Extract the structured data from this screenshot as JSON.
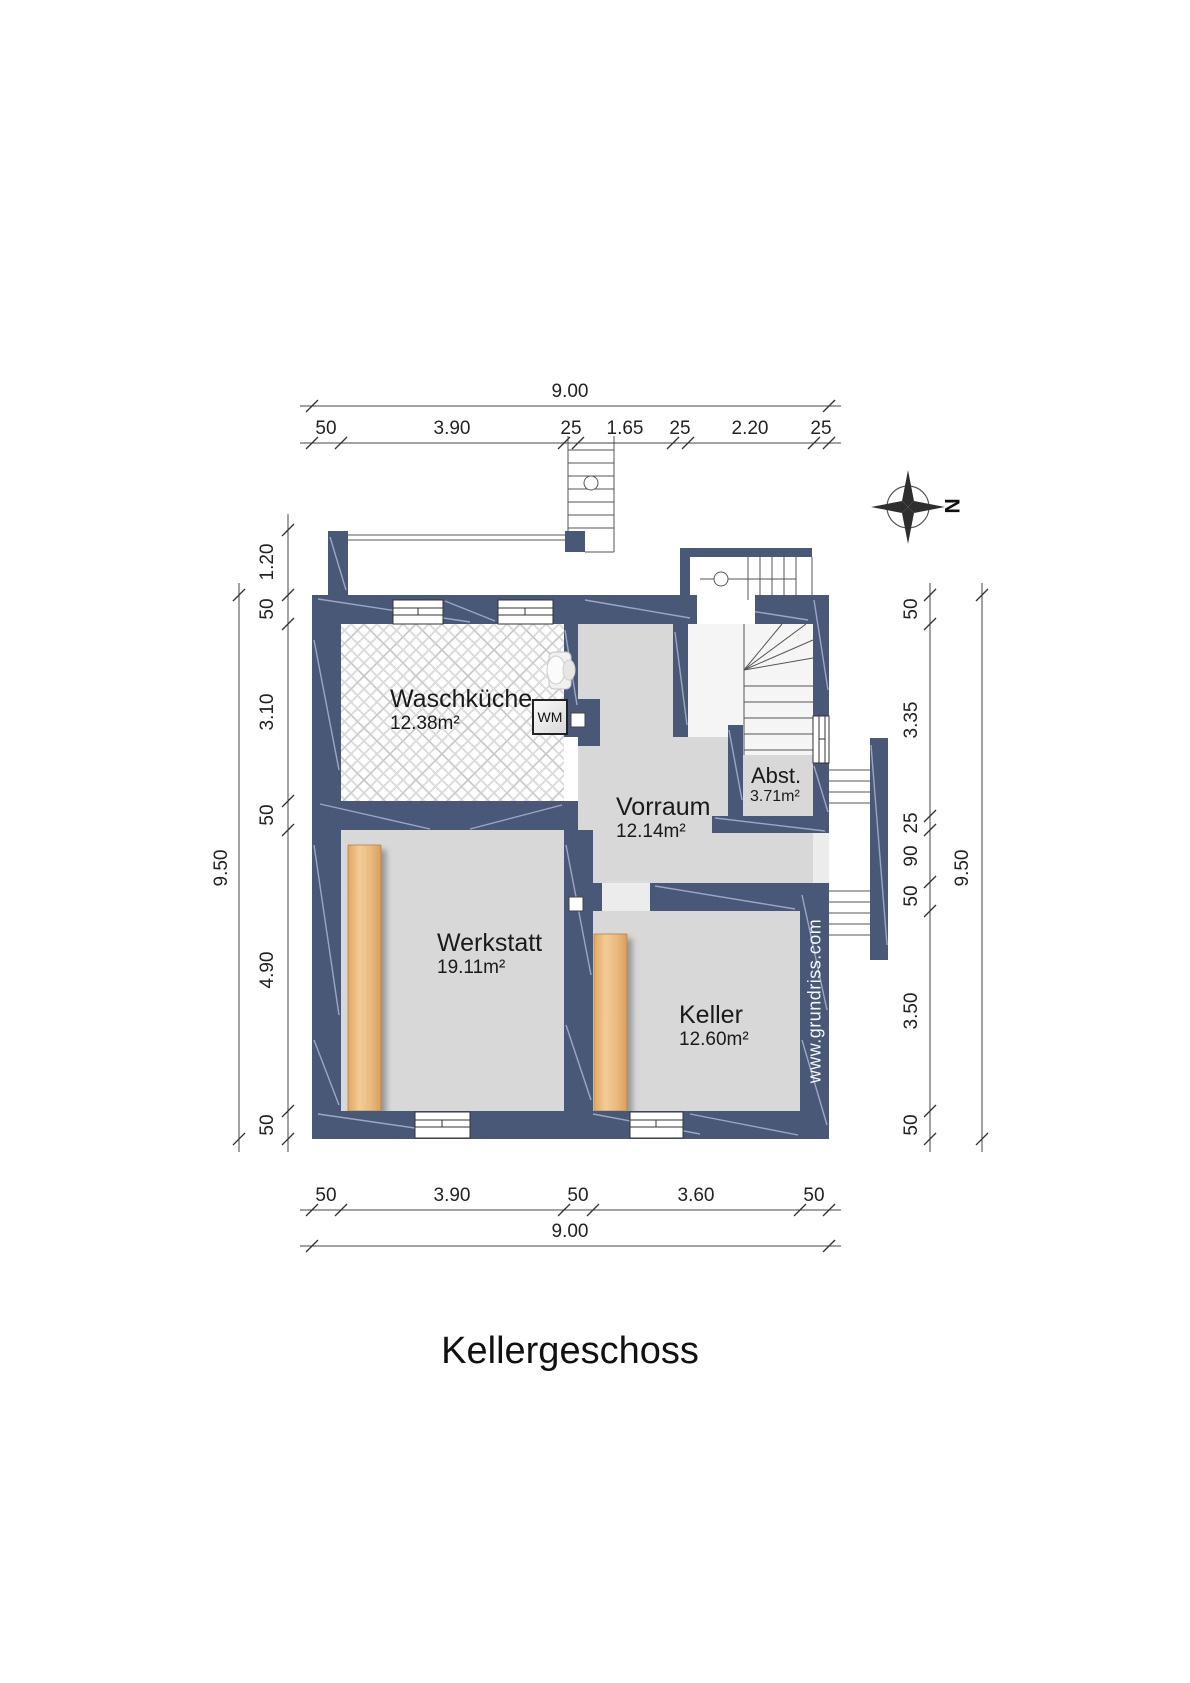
{
  "title": "Kellergeschoss",
  "watermark": "www.grundriss.com",
  "compass": {
    "north_label": "N"
  },
  "rooms": {
    "waschkueche": {
      "name": "Waschküche",
      "area": "12.38m²"
    },
    "vorraum": {
      "name": "Vorraum",
      "area": "12.14m²"
    },
    "abstellraum": {
      "name": "Abst.",
      "area": "3.71m²"
    },
    "werkstatt": {
      "name": "Werkstatt",
      "area": "19.11m²"
    },
    "keller": {
      "name": "Keller",
      "area": "12.60m²"
    }
  },
  "appliances": {
    "washing_machine": "WM"
  },
  "dimensions": {
    "top": {
      "total": "9.00",
      "chain": [
        "50",
        "3.90",
        "25",
        "1.65",
        "25",
        "2.20",
        "25"
      ]
    },
    "bottom": {
      "total": "9.00",
      "chain": [
        "50",
        "3.90",
        "50",
        "3.60",
        "50"
      ]
    },
    "left": {
      "total": "9.50",
      "chain": [
        "1.20",
        "50",
        "3.10",
        "50",
        "4.90",
        "50"
      ]
    },
    "right": {
      "total": "9.50",
      "chain": [
        "50",
        "3.35",
        "25",
        "90",
        "50",
        "3.50",
        "50"
      ]
    }
  },
  "colors": {
    "wall": "#4a5878",
    "wall_accent": "#a9b4cf",
    "floor": "#d8d8d8",
    "wood": "#eebc80"
  }
}
